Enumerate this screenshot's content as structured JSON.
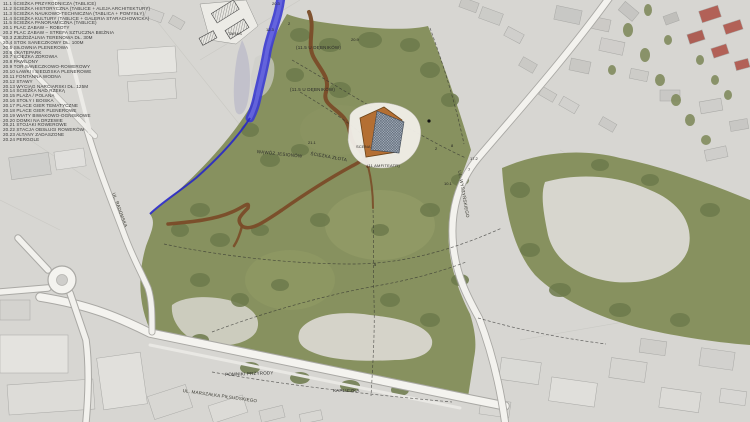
{
  "legend": {
    "items": [
      "11.1  ŚCIEŻKA PRZYRODNICZA (TABLICE)",
      "11.2  ŚCIEŻKA HISTORYCZNA (TABLICE + ALEJA ARCHITEKTURY)",
      "11.3  ŚCIEŻKA NAUKOWO-TECHNICZNA (TABLICA + POMYSŁY)",
      "11.4  ŚCIEŻKA KULTURY (TABLICE + GALERIA STARACHOWICKA)",
      "11.5  ŚCIEŻKA PANORAMICZNA (TABLICE)",
      "20.1  PLAC ZABAW – ROBOTY",
      "20.2  PLAC ZABAW – STREFA SZTUCZNA BIEŻNIA",
      "20.3  ZJEŻDŻALNIA TERENOWA DŁ. 30M",
      "20.4  STOK SANECZKOWY DŁ. 100M",
      "20.5  SIŁOWNIA PLENEROWA",
      "20.6  SKATEPARK",
      "20.7  ŚCIEŻKA ZDROWIA",
      "20.8  PAWILONY",
      "20.9  TOR SANECZKOWO-ROWEROWY",
      "20.10 ŁAWKI I SIEDZISKA PLENEROWE",
      "20.11 FONTANNA WODNA",
      "20.12 STAWY",
      "20.13 WYCIĄG NARCIARSKI DŁ. 125M",
      "20.14 ŚCIEŻKA NAD RZEKĄ",
      "20.15 PLAŻA / POLANA",
      "20.16 STOŁY I BOISKA",
      "20.17 PLACE GIER TEMATYCZNE",
      "20.18 PLACE GIER PLENEROWE",
      "20.19 WIATY BIWAKOWO-OGNISKOWE",
      "20.20 DOMKI NA DRZEWIE",
      "20.21 STOJAKI ROWEROWE",
      "20.22 STACJA OBSŁUGI ROWERÓW",
      "20.23 ALTANY ZADASZONE",
      "20.24 PERGOLE"
    ]
  },
  "map": {
    "labels": {
      "taras": "TARAS",
      "scena": "SCENA",
      "amfiteatr": "(11 AMFITEATR)",
      "sciezka_zlota": "ŚCIEŻKA ZŁOTA",
      "wawoz": "WĄWÓZ JESIONÓW",
      "u_debnikow_1": "(11.5 U DĘBNIKÓW)",
      "u_debnikow_2": "(11.5 U DĘBNIKÓW)",
      "pomniki": "POMNIKI PRZYRODY",
      "kapliczka": "KAPLICZKA",
      "ul_pilsudskiego": "UL. MARSZAŁKA PIŁSUDSKIEGO",
      "ul_radomska": "UL. RADOMSKA",
      "ul_wyszynskiego": "UL. WYSZYŃSKIEGO"
    },
    "markers": [
      "20.3",
      "12.3",
      "2",
      "20.9",
      "21.1",
      "17.2",
      "7",
      "10.1",
      "2",
      "8",
      "5"
    ]
  },
  "colors": {
    "park_green": "#87915f",
    "tree_green": "#6d7a4c",
    "river_blue": "#3b3bd0",
    "trail_brown": "#7a4c28",
    "urban_gray": "#d7d6d2",
    "roof_red": "#b26157",
    "road_white": "#f4f3ef"
  }
}
